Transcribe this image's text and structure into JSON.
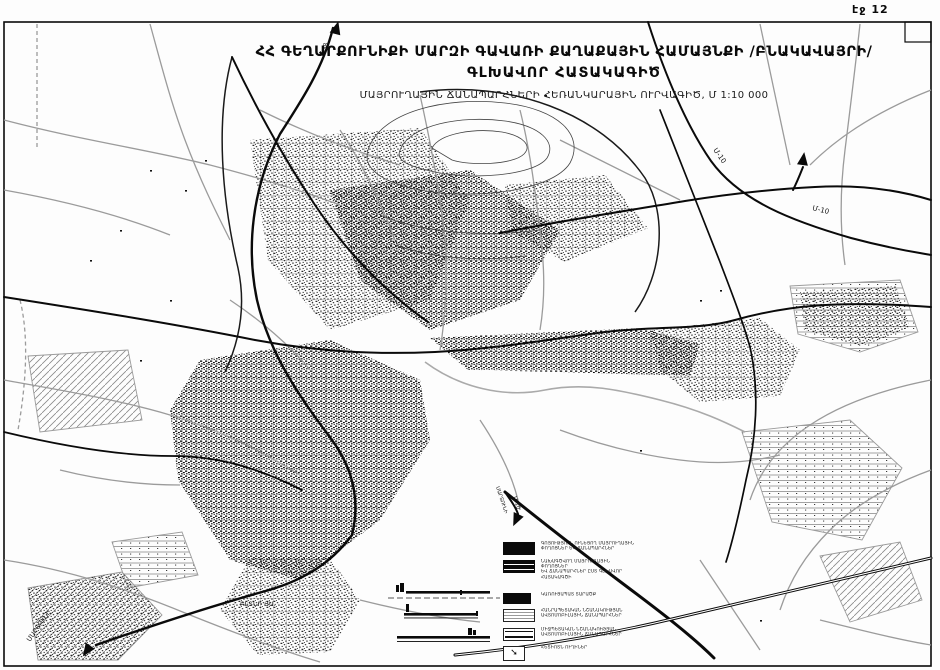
{
  "page": {
    "page_label": "էջ 12"
  },
  "title": {
    "line1": "ՀՀ ԳԵՂԱՐՔՈՒՆԻՔԻ ՄԱՐԶԻ ԳԱՎԱՌԻ ՔԱՂԱՔԱՅԻՆ ՀԱՄԱՅՆՔԻ /ԲՆԱԿԱՎԱՅՐԻ/",
    "line2": "ԳԼԽԱՎՈՐ ՀԱՏԱԿԱԳԻԾ",
    "line3": "ՄԱՅՐՈՒՂԱՅԻՆ ՃԱՆԱՊԱՐՀՆԵՐԻ ՀԵՌԱՆԿԱՐԱՅԻՆ ՈՒՐՎԱԳԻԾ, Մ 1:10 000"
  },
  "map": {
    "scale": "Մ 1:10 000",
    "labels": {
      "m10_upper": "Մ-10",
      "m10_lower": "Մ-10",
      "h38": "Հ-38",
      "martuni_corner": "ՄԱՐՏՈՒՆԻ",
      "martuni_south": "ՄԱՐՏՈՒՆԻ",
      "m10_south": "Մ-10",
      "district": "ԲԼՏՆԻ ՅԱ."
    }
  },
  "legend": {
    "items": [
      {
        "symbol": "existing-main-road-solid",
        "label": "ԳՈՅՈՒԹՅՈՒՆ ՈՒՆԵՑՈՂ ՄԱՅՐՈՒՂԱՅԻՆ\nՓՈՂՈՑՆԵՐ ԵՎ ՃԱՆԱՊԱՐՀՆԵՐ"
      },
      {
        "symbol": "planned-main-road-striped",
        "label": "ՆԱԽԱԳԾՎՈՂ ՄԱՅՐՈՒՂԱՅԻՆ ՓՈՂՈՑՆԵՐ\nԵՎ ՃԱՆԱՊԱՐՀՆԵՐ ԸՍՏ ԳԼԽԱՎՈՐ\nՀԱՏԱԿԱԳԾԻ"
      },
      {
        "symbol": "built-up-area-solid",
        "label": "ԿԱՌՈՒՑԱՊԱՏ ՏԱՐԱԾՔ"
      },
      {
        "symbol": "republican-road-lined",
        "label": "ՀԱՆՐԱՊԵՏԱԿԱՆ ՆՇԱՆԱԿՈՒԹՅԱՆ\nԱՎՏՈՄՈԲԻԼԱՅԻՆ ՃԱՆԱՊԱՐՀՆԵՐ"
      },
      {
        "symbol": "interstate-road-double-lined",
        "label": "ՄԻՋՊԵՏԱԿԱՆ ՆՇԱՆԱԿՈՒԹՅԱՆ\nԱՎՏՈՄՈԲԻԼԱՅԻՆ ՃԱՆԱՊԱՐՀՆԵՐ"
      },
      {
        "symbol": "pedestrian-route-arrow",
        "label": "ՀԵՏԻՈՏՆ ՈՒՂԻՆԵՐ",
        "glyph": "➘"
      }
    ]
  },
  "colors": {
    "ink": "#0a0a0a",
    "gray_road": "#9b9b9b",
    "paper": "#fdfdfd"
  }
}
